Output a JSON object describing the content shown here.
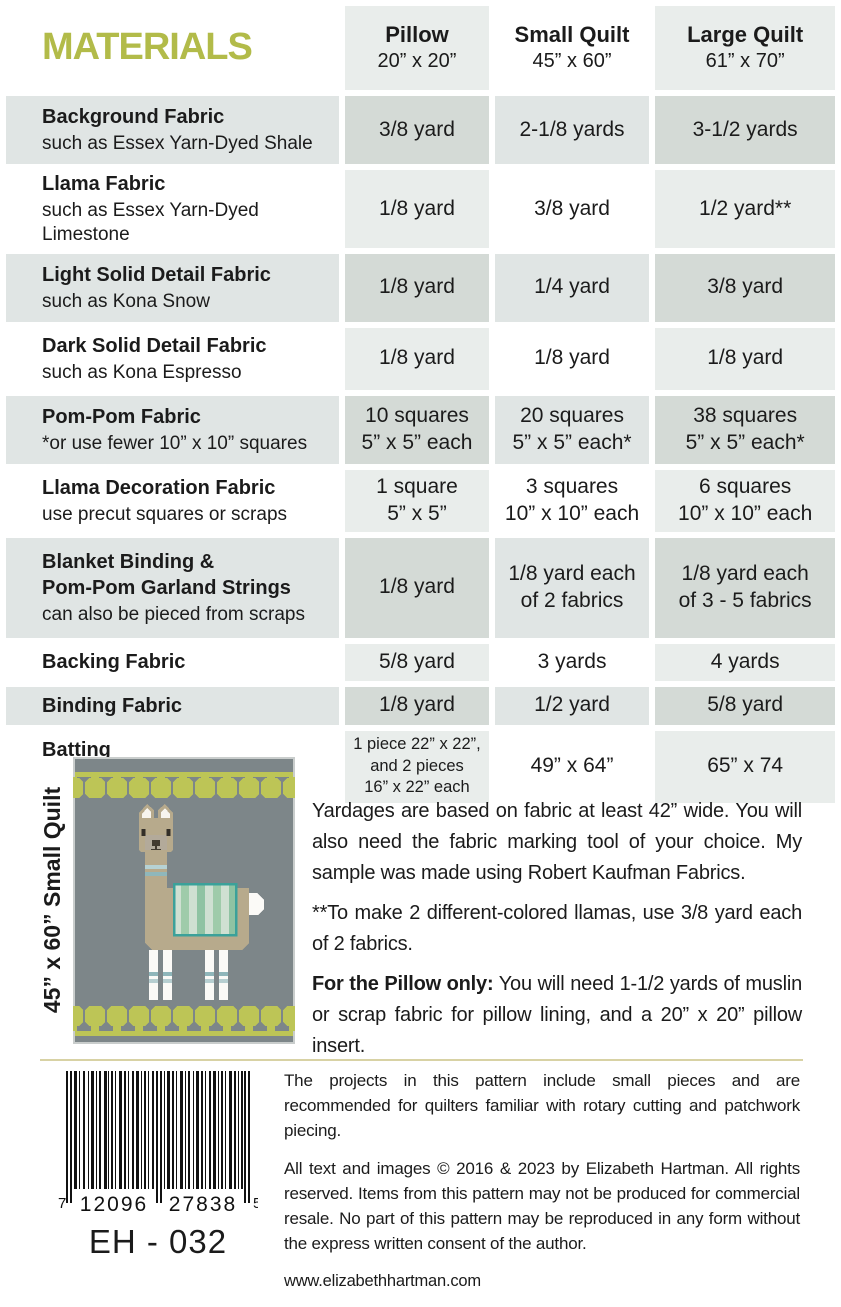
{
  "title": "MATERIALS",
  "columns": [
    {
      "name": "Pillow",
      "size": "20” x 20”"
    },
    {
      "name": "Small Quilt",
      "size": "45” x 60”"
    },
    {
      "name": "Large Quilt",
      "size": "61” x 70”"
    }
  ],
  "rows": [
    {
      "label": "Background Fabric",
      "sub": "such as Essex Yarn-Dyed Shale",
      "pillow": "3/8 yard",
      "small": "2-1/8 yards",
      "large": "3-1/2 yards"
    },
    {
      "label": "Llama Fabric",
      "sub": "such as Essex Yarn-Dyed Limestone",
      "pillow": "1/8 yard",
      "small": "3/8 yard",
      "large": "1/2 yard**"
    },
    {
      "label": "Light Solid Detail Fabric",
      "sub": "such as Kona Snow",
      "pillow": "1/8 yard",
      "small": "1/4 yard",
      "large": "3/8 yard"
    },
    {
      "label": "Dark Solid Detail Fabric",
      "sub": "such as Kona Espresso",
      "pillow": "1/8 yard",
      "small": "1/8 yard",
      "large": "1/8 yard"
    },
    {
      "label": "Pom-Pom Fabric",
      "sub": "*or use fewer 10” x 10” squares",
      "pillow": "10 squares\n5” x 5” each",
      "small": "20 squares\n5” x 5” each*",
      "large": "38 squares\n5” x 5” each*"
    },
    {
      "label": "Llama Decoration Fabric",
      "sub": "use precut squares or scraps",
      "pillow": "1 square\n5” x 5”",
      "small": "3 squares\n10” x 10” each",
      "large": "6 squares\n10” x 10” each"
    },
    {
      "label": "Blanket Binding &\nPom-Pom Garland Strings",
      "sub": "can also be pieced from scraps",
      "pillow": "1/8 yard",
      "small": "1/8 yard each\nof 2 fabrics",
      "large": "1/8 yard each\nof 3 - 5 fabrics"
    },
    {
      "label": "Backing Fabric",
      "sub": "",
      "pillow": "5/8 yard",
      "small": "3 yards",
      "large": "4 yards"
    },
    {
      "label": "Binding Fabric",
      "sub": "",
      "pillow": "1/8 yard",
      "small": "1/2 yard",
      "large": "5/8 yard"
    },
    {
      "label": "Batting",
      "sub": "",
      "pillow": "1 piece 22” x 22”,\nand 2 pieces\n16” x 22” each",
      "small": "49” x 64”",
      "large": "65” x 74"
    }
  ],
  "quilt": {
    "caption": "45” x 60” Small Quilt"
  },
  "notes": {
    "p1": "Yardages are based on fabric at least 42” wide. You will also need the fabric marking tool of your choice. My sample was made using Robert Kaufman Fabrics.",
    "p2": "**To make 2 different-colored llamas, use 3/8 yard each of 2 fabrics.",
    "p3_lead": "For the Pillow only:",
    "p3_rest": " You will need 1-1/2 yards of muslin or scrap fabric for pillow lining, and a 20” x 20” pillow insert."
  },
  "footer": {
    "barcode": {
      "left_digit": "7",
      "group1": "12096",
      "group2": "27838",
      "right_digit": "5",
      "code": "EH - 032"
    },
    "p1": "The projects in this pattern include small pieces and are recommended for quilters familiar with rotary cutting and patchwork piecing.",
    "p2": "All text and images © 2016 & 2023 by Elizabeth Hartman. All rights reserved. Items from this pattern may not be produced for commercial resale. No part of this pattern may be reproduced in any form without the express written consent of the author.",
    "website": "www.elizabethhartman.com"
  },
  "colors": {
    "accent_olive": "#b2bb49",
    "row_shade": "#e0e5e4",
    "column_tint": "#e9edeb",
    "shade_intersection": "#d4dad6",
    "divider_khaki": "#d8d2a4",
    "quilt_gray": "#7d8689",
    "pom_green": "#bdc556",
    "llama_tan": "#b7aa8c",
    "blanket_teal": "#3ba19a"
  }
}
